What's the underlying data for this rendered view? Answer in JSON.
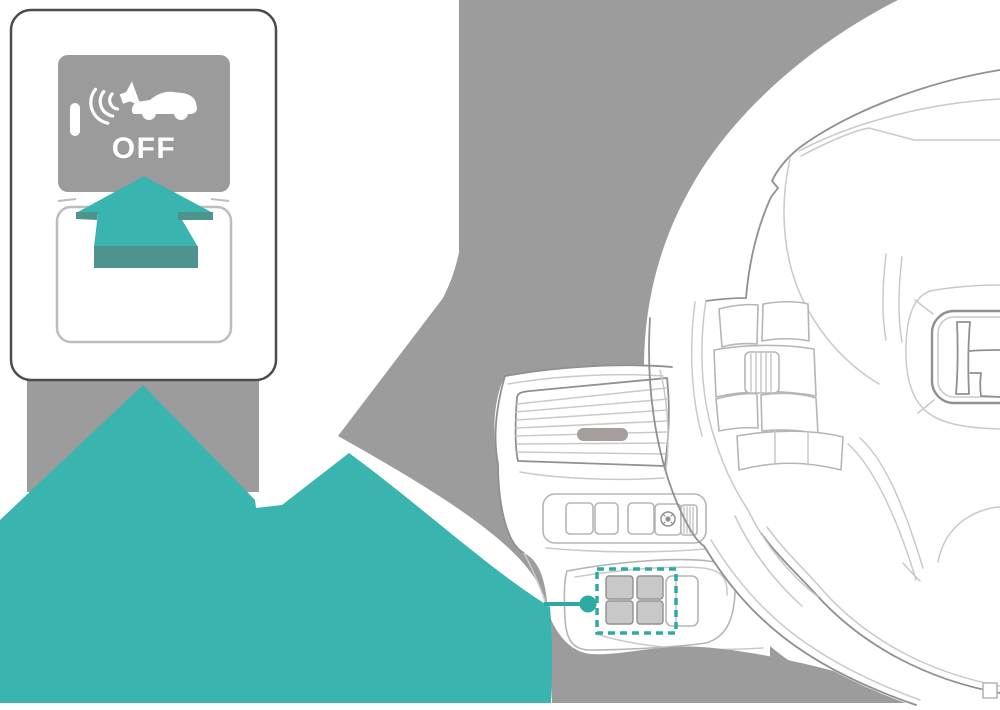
{
  "callout": {
    "button_label": "OFF",
    "button_icon": "sound-waves-car-icon",
    "indicator_icon": "indicator-lamp-bar",
    "action_icon": "press-up-arrow-icon"
  },
  "highlight": {
    "style": "dashed-rectangle",
    "connector": "dot-and-line"
  },
  "colors": {
    "teal": "#3AB4AE",
    "tealDark": "#4F938F",
    "tealAccent": "#2EA9A4",
    "grayBg": "#9C9C9C",
    "grayButton": "#9B9B9B",
    "line": "#909090",
    "lineLight": "#C9C9C9",
    "btnLine": "#B5B5B5",
    "buttonFill": "#C8C8C8",
    "pill": "#A59E9B",
    "calloutBorder": "#4C4C4C",
    "baseStroke": "#BDBDBD"
  }
}
